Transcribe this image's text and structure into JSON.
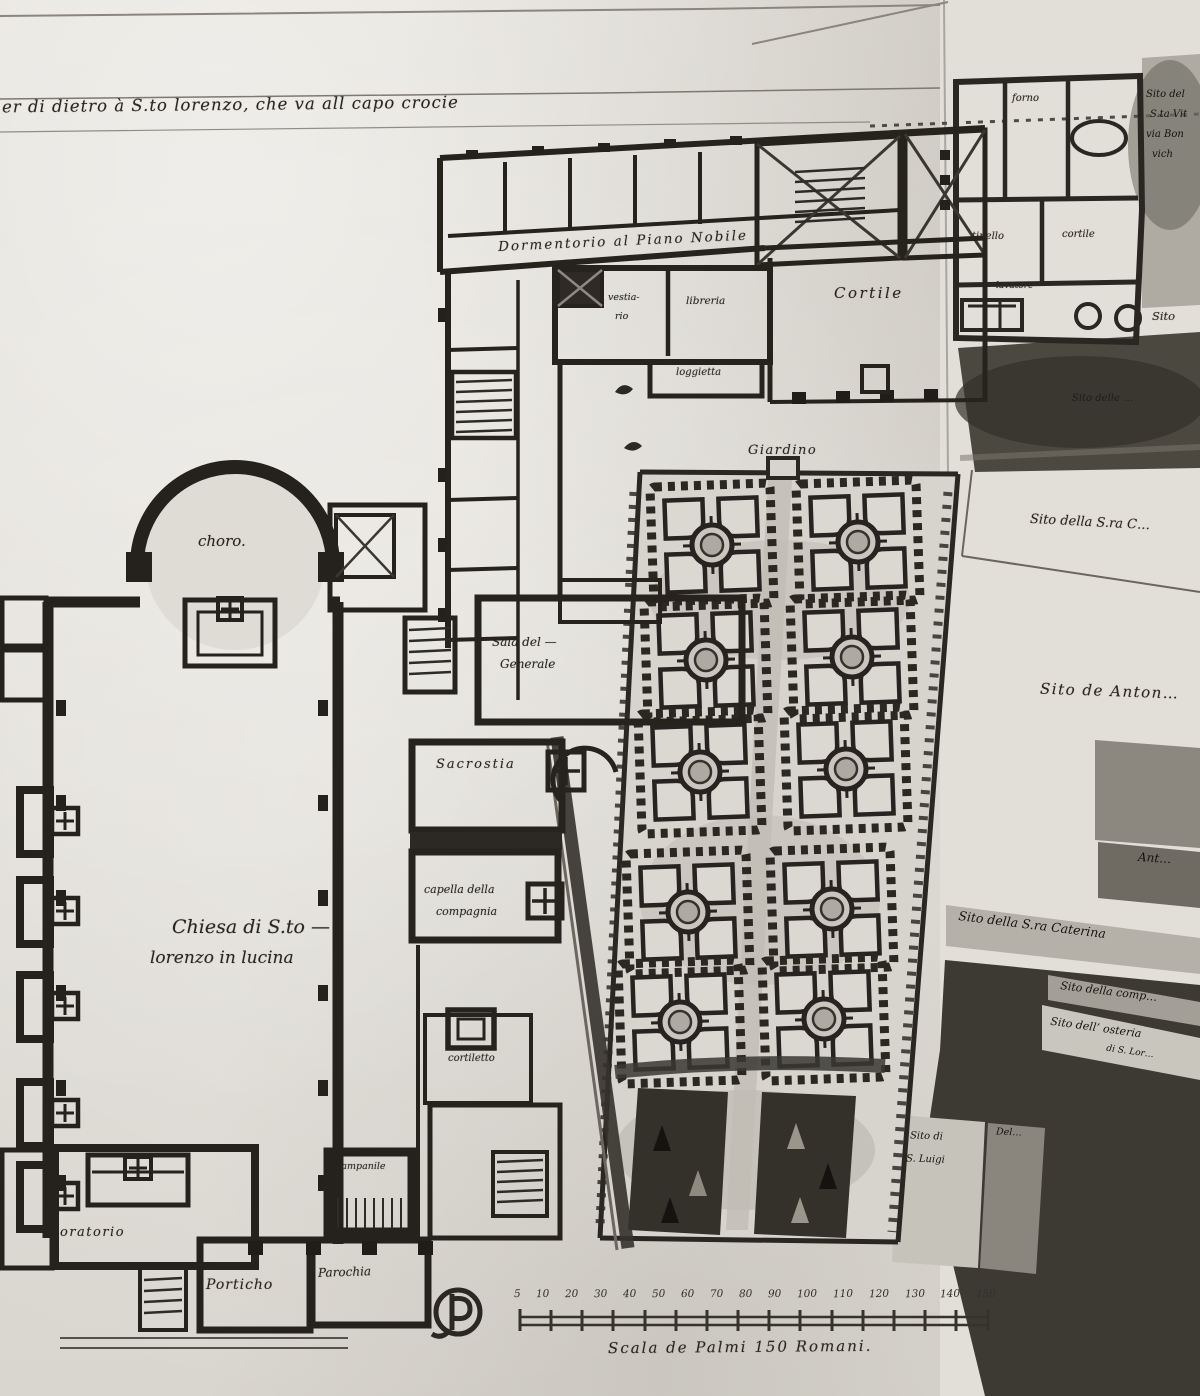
{
  "sheet": {
    "inscription": "er di dietro à S.to lorenzo, che va all capo crocie",
    "type_note": "hand-drawn architectural plan, pen and wash"
  },
  "labels": {
    "choro": "choro.",
    "chiesa_line1": "Chiesa di S.to —",
    "chiesa_line2": "lorenzo in lucina",
    "sacrestia": "Sacrostia",
    "capella_line1": "capella della",
    "capella_line2": "compagnia",
    "cortiletto": "cortiletto",
    "campanile": "campanile",
    "oratorio": "oratorio",
    "porticho": "Porticho",
    "parochia": "Parochia",
    "dormentorio": "Dormentorio  al Piano Nobile  .",
    "vestiario_line1": "vestia-",
    "vestiario_line2": "rio",
    "libreria": "libreria",
    "loggetta": "loggietta",
    "cortile": "Cortile",
    "giardino": "Giardino",
    "sala_line1": "Sala del —",
    "sala_line2": "Generale",
    "forno": "forno",
    "tinello": "tinello",
    "cortile_small": "cortile",
    "lavatore": "lavatore",
    "sito_nw_line1": "Sito del",
    "sito_nw_line2": "S.ta Vit",
    "sito_nw_line3": "via Bon",
    "sito_nw_line4": "vich",
    "sito_right": "Sito",
    "sito_delle": "Sito delle …",
    "sito_sra_c": "Sito della S.ra C…",
    "sito_anton": "Sito de Anton…",
    "ant_fragment": "Ant…",
    "sito_caterina": "Sito della S.ra Caterina",
    "sito_comp": "Sito della comp…",
    "sito_osteria_line1": "Sito dell’ osteria",
    "sito_osteria_line2": "di S. Lor…",
    "sito_luigi_line1": "Sito di",
    "sito_luigi_line2": "S. Luigi",
    "del_fragment": "Del…"
  },
  "scale_bar": {
    "caption": "Scala de Palmi 150 Romani.",
    "ticks": [
      "5",
      "10",
      "20",
      "30",
      "40",
      "50",
      "60",
      "70",
      "80",
      "90",
      "100",
      "110",
      "120",
      "130",
      "140",
      "150"
    ]
  },
  "marks": {
    "collector_mark": "circled-P monogram",
    "sketch_marks": "two small ink flourishes beside garden wall"
  },
  "palette": {
    "paper": "#dedbd4",
    "ink": "#26221c",
    "wash_dark": "#3b3831",
    "wash_mid": "#6f6b62",
    "wash_light": "#b5b1a8"
  }
}
